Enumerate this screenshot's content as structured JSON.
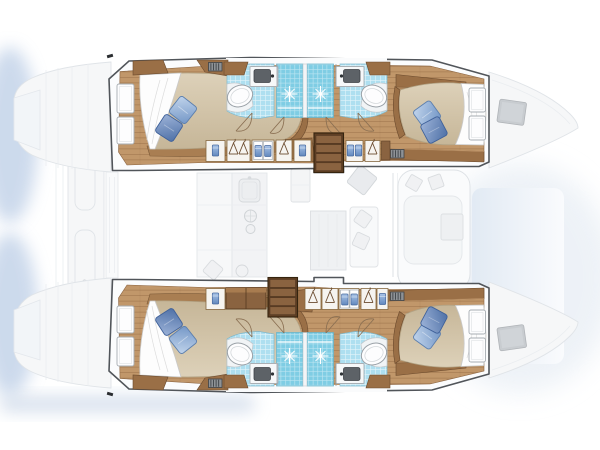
{
  "scene": {
    "kind": "catamaran yacht interior floor plan, top-down",
    "orientation": "bows pointing right, transom steps at left",
    "hulls": 2,
    "cabins": 4,
    "double_beds": 4,
    "pillows_per_bed": 2,
    "bathrooms": 4,
    "shower_stalls": 4,
    "companionway_steps": 2,
    "regions": {
      "port_hull": [
        "aft-cabin",
        "aft-bathroom",
        "shower",
        "wardrobes",
        "companionway-steps",
        "forward-bathroom",
        "forward-cabin",
        "bow-window"
      ],
      "starboard_hull": [
        "aft-cabin",
        "aft-bathroom",
        "shower",
        "wardrobes",
        "companionway-steps",
        "forward-bathroom",
        "forward-cabin",
        "bow-window"
      ],
      "saloon_ghost": [
        "galley-counter",
        "galley-sink",
        "stove-burners",
        "fridge",
        "dinette-table",
        "sofa-bench",
        "seat",
        "forward-cockpit",
        "forward-cockpit-table"
      ],
      "exterior_ghost": [
        "transom-steps",
        "aft-cockpit-bench",
        "bow-points",
        "trampoline-shadow"
      ]
    }
  },
  "palette": {
    "wood_floor": "#c1976a",
    "wood_cabinet": "#9a6f46",
    "step_brown": "#5f3f24",
    "step_tread": "#8a6340",
    "mattress_a": "#ddd1b9",
    "mattress_b": "#c6b698",
    "sheet_white": "#fdfdfd",
    "pillow_light_a": "#c2d5ec",
    "pillow_light_b": "#7396c6",
    "pillow_dark_a": "#9db3d8",
    "pillow_dark_b": "#4e70a6",
    "tile_blue": "#aedff0",
    "shower_blue": "#7fcde4",
    "towel_a": "#a9c4e8",
    "towel_b": "#6288bd",
    "fixture_white": "#fdfdfe",
    "fixture_stroke": "#a7adb2",
    "sink_gray": "#5d6267",
    "hull_line": "#51555a",
    "deck_white": "#fbfcfd",
    "ghost_fill": "#f6f7f8",
    "ghost_stroke": "#e0e4e8",
    "window_gray": "#c8ccd0",
    "shadow_blue": "#bccee6",
    "tramp_a": "#e0e9f3",
    "tramp_b": "#fbfcfe"
  }
}
